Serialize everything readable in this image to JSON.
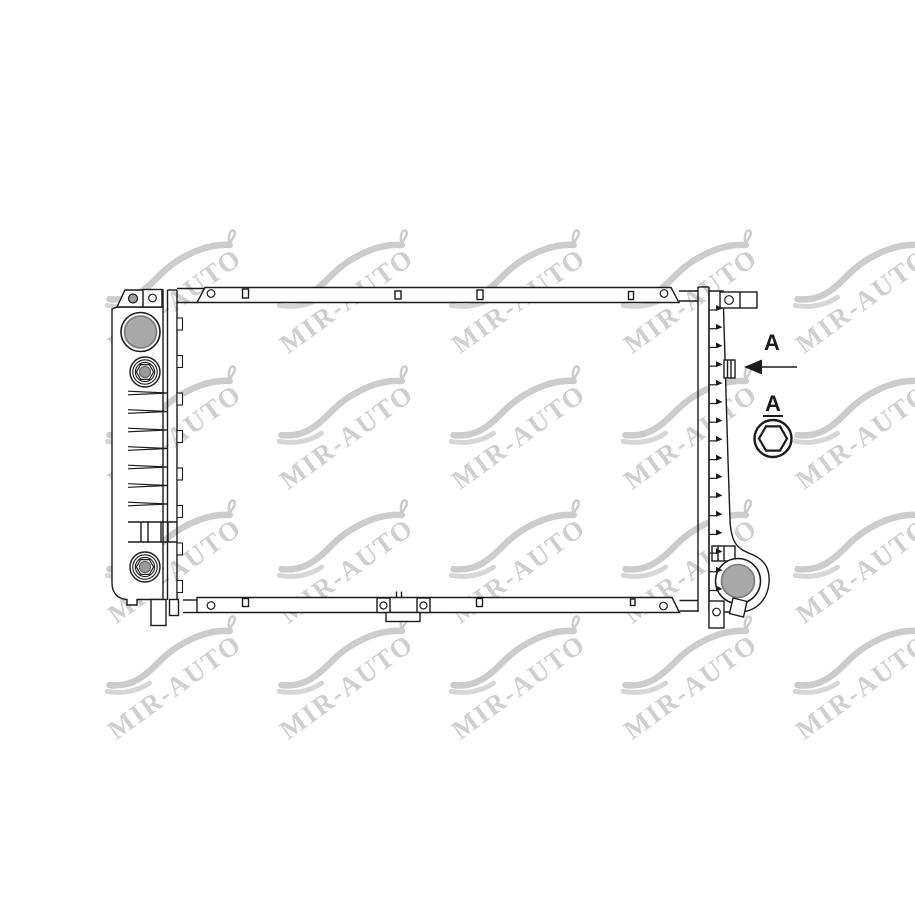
{
  "watermark": {
    "text": "MIR-AUTO"
  },
  "annotation": {
    "arrow_label": "A",
    "detail_label": "A"
  },
  "colors": {
    "background": "#ffffff",
    "line": "#1b1b1b",
    "port_fill": "#a9a9a9",
    "cap_fill": "#9a9a9a",
    "watermark": "#c7c7c7"
  }
}
